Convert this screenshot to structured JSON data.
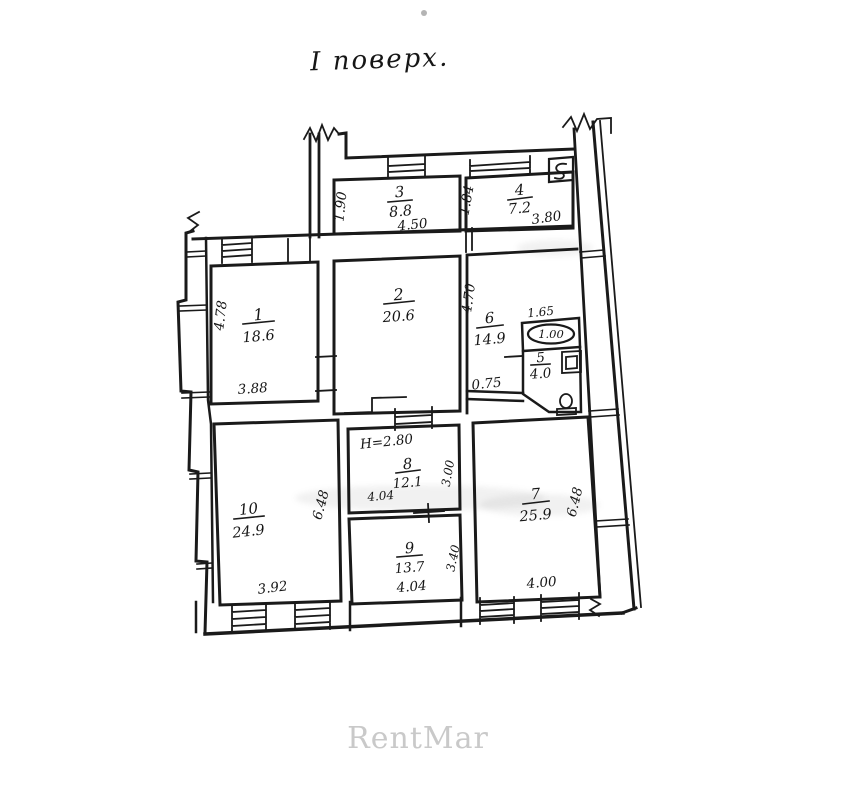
{
  "title": "І поверх.",
  "watermark": "RentMar",
  "colors": {
    "ink": "#1a1a1a",
    "paper": "#ffffff",
    "watermark_gray": "#c9c9c9"
  },
  "rooms": {
    "r1": {
      "number": "1",
      "area": "18.6",
      "dim_bottom": "3.88",
      "dim_side": "4.78"
    },
    "r2": {
      "number": "2",
      "area": "20.6"
    },
    "r3": {
      "number": "3",
      "area": "8.8",
      "dim_bottom": "4.50",
      "dim_side": "1.90"
    },
    "r4": {
      "number": "4",
      "area": "7.2",
      "dim_bottom": "3.80",
      "dim_side": "1.84"
    },
    "r5": {
      "number": "5",
      "area": "4.0",
      "closet_area": "1.00",
      "dim_top": "1.65"
    },
    "r6": {
      "number": "6",
      "area": "14.9",
      "dim_side": "4.70",
      "dim_bottom": "0.75"
    },
    "r7": {
      "number": "7",
      "area": "25.9",
      "dim_bottom": "4.00",
      "dim_side": "6.48"
    },
    "r8": {
      "number": "8",
      "area": "12.1",
      "dim_bottom": "4.04",
      "dim_side": "3.00",
      "height_note": "Н=2.80"
    },
    "r9": {
      "number": "9",
      "area": "13.7",
      "dim_bottom": "4.04",
      "dim_side": "3.40"
    },
    "r10": {
      "number": "10",
      "area": "24.9",
      "dim_bottom": "3.92",
      "dim_side": "6.48"
    }
  }
}
